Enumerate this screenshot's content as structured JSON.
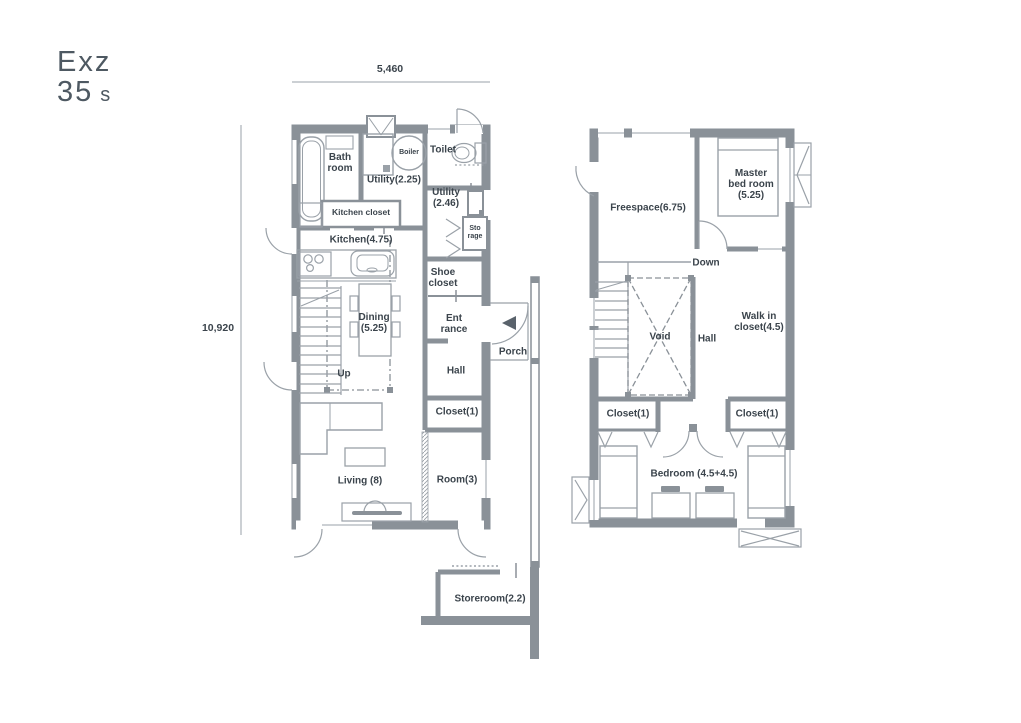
{
  "logo": {
    "line1": "Exz",
    "line2": "35",
    "suffix": "s"
  },
  "dimensions": {
    "width": "5,460",
    "height": "10,920"
  },
  "floor1": {
    "bath_room": "Bath\nroom",
    "boiler": "Boiler",
    "toilet": "Toilet",
    "utility_225": "Utility(2.25)",
    "utility_246": "Utility\n(2.46)",
    "kitchen_closet": "Kitchen closet",
    "kitchen": "Kitchen(4.75)",
    "storage": "Sto\nrage",
    "shoe_closet": "Shoe\ncloset",
    "entrance": "Ent\nrance",
    "porch": "Porch",
    "dining": "Dining\n(5.25)",
    "up": "Up",
    "hall": "Hall",
    "closet": "Closet(1)",
    "living": "Living  (8)",
    "room": "Room(3)",
    "storeroom": "Storeroom(2.2)"
  },
  "floor2": {
    "freespace": "Freespace(6.75)",
    "master_bedroom": "Master\nbed room\n(5.25)",
    "down": "Down",
    "void": "Void",
    "hall": "Hall",
    "walk_in_closet": "Walk in\ncloset(4.5)",
    "closet_left": "Closet(1)",
    "closet_right": "Closet(1)",
    "bedroom": "Bedroom  (4.5+4.5)"
  },
  "colors": {
    "wall": "#8a9198",
    "fixture_line": "#9aa1a8",
    "text": "#3b444c",
    "logo": "#4e5962"
  }
}
